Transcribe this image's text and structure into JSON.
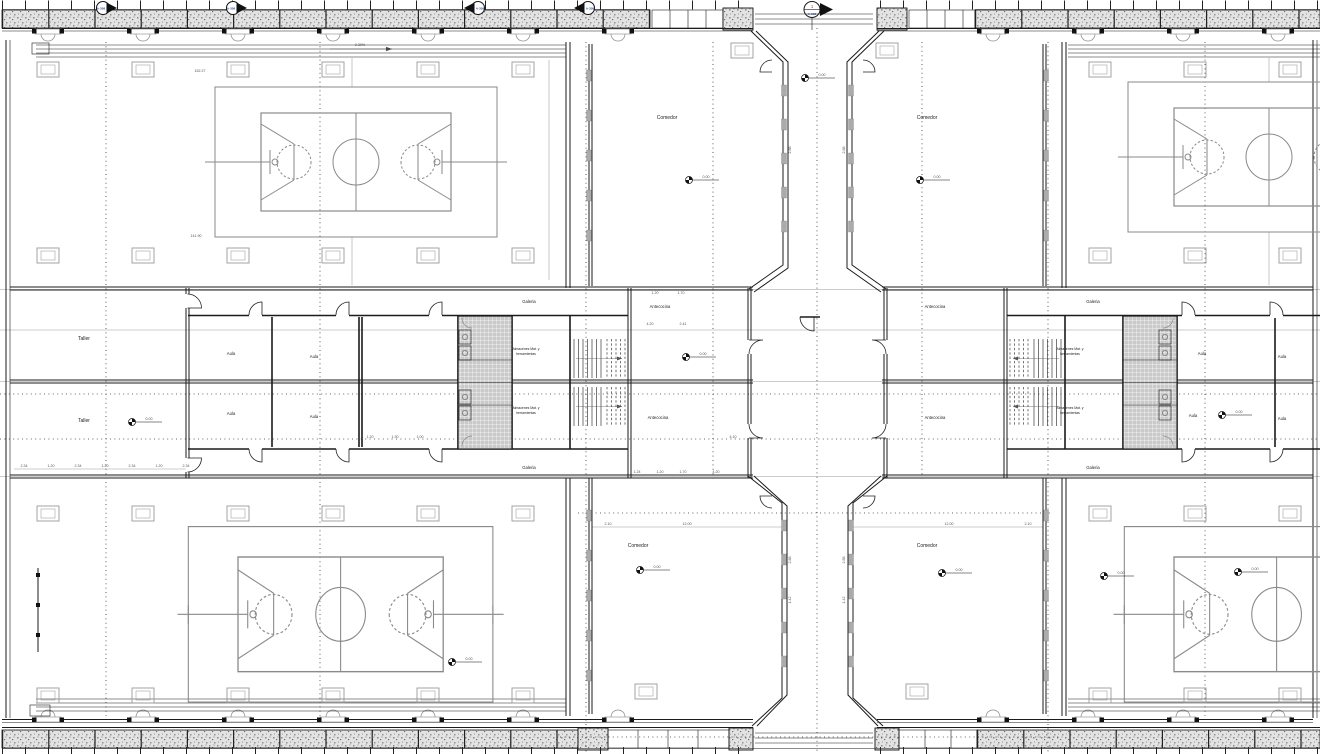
{
  "plan": {
    "rooms": {
      "comedor": "Comedor",
      "taller": "Taller",
      "aula": "Aula",
      "galeria": "Galeria",
      "antecocina": "Antecocina",
      "almacenes1": "Almacenes Mat. y",
      "almacenes2": "herramientas"
    },
    "levels": {
      "zero": "0.00"
    },
    "markers": {
      "section_ref": "A-308",
      "section_no": "1",
      "slope": "2.30%"
    },
    "dims": {
      "a": "152.27",
      "b": "141.90",
      "chain": [
        "2.34",
        "1.20",
        "2.34",
        "1.20",
        "2.34",
        "1.20",
        "2.34"
      ],
      "c1": "1.20",
      "c2": "1.70",
      "c3": "4.20",
      "c4": "2.41",
      "c5": "1.24",
      "c6": "1.20",
      "c7": "1.70",
      "c8": "4.20",
      "c9": "4.10",
      "w1": "12.00",
      "w2": "2.10",
      "v1": "2.88",
      "v2": "1.42",
      "r1": "1.20",
      "r2": "1.30",
      "r3": "1.00"
    }
  }
}
